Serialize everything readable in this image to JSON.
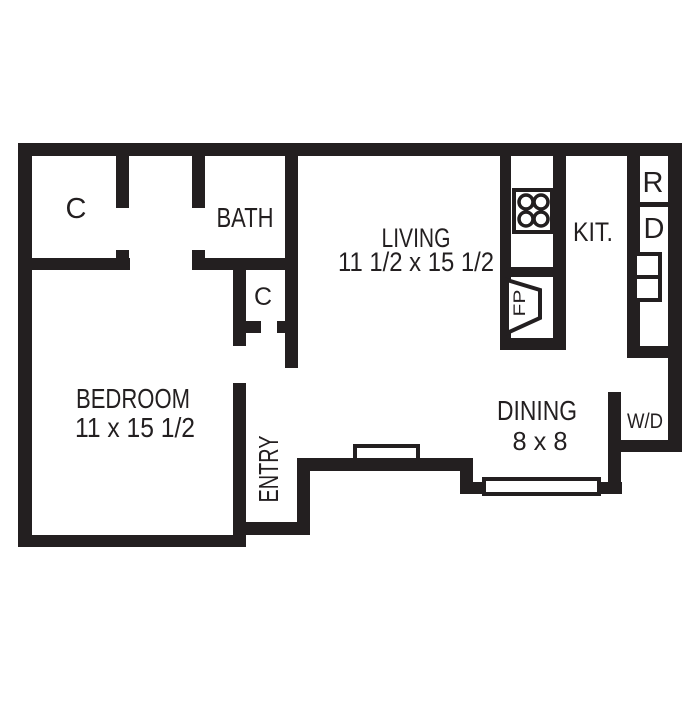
{
  "floorplan": {
    "colors": {
      "wall": "#231f20",
      "floor": "#ffffff"
    },
    "rooms": {
      "closet_top_left": {
        "label": "C"
      },
      "bath": {
        "label": "BATH"
      },
      "living": {
        "label": "LIVING",
        "dimensions": "11 1/2 x 15 1/2"
      },
      "kitchen": {
        "label": "KIT."
      },
      "closet_hall": {
        "label": "C"
      },
      "bedroom": {
        "label": "BEDROOM",
        "dimensions": "11 x 15 1/2"
      },
      "entry": {
        "label": "ENTRY"
      },
      "dining": {
        "label": "DINING",
        "dimensions": "8 x 8"
      }
    },
    "fixtures": {
      "refrigerator": {
        "label": "R"
      },
      "dishwasher": {
        "label": "D"
      },
      "washer_dryer": {
        "label": "W/D"
      },
      "fireplace": {
        "label": "FP"
      }
    }
  }
}
